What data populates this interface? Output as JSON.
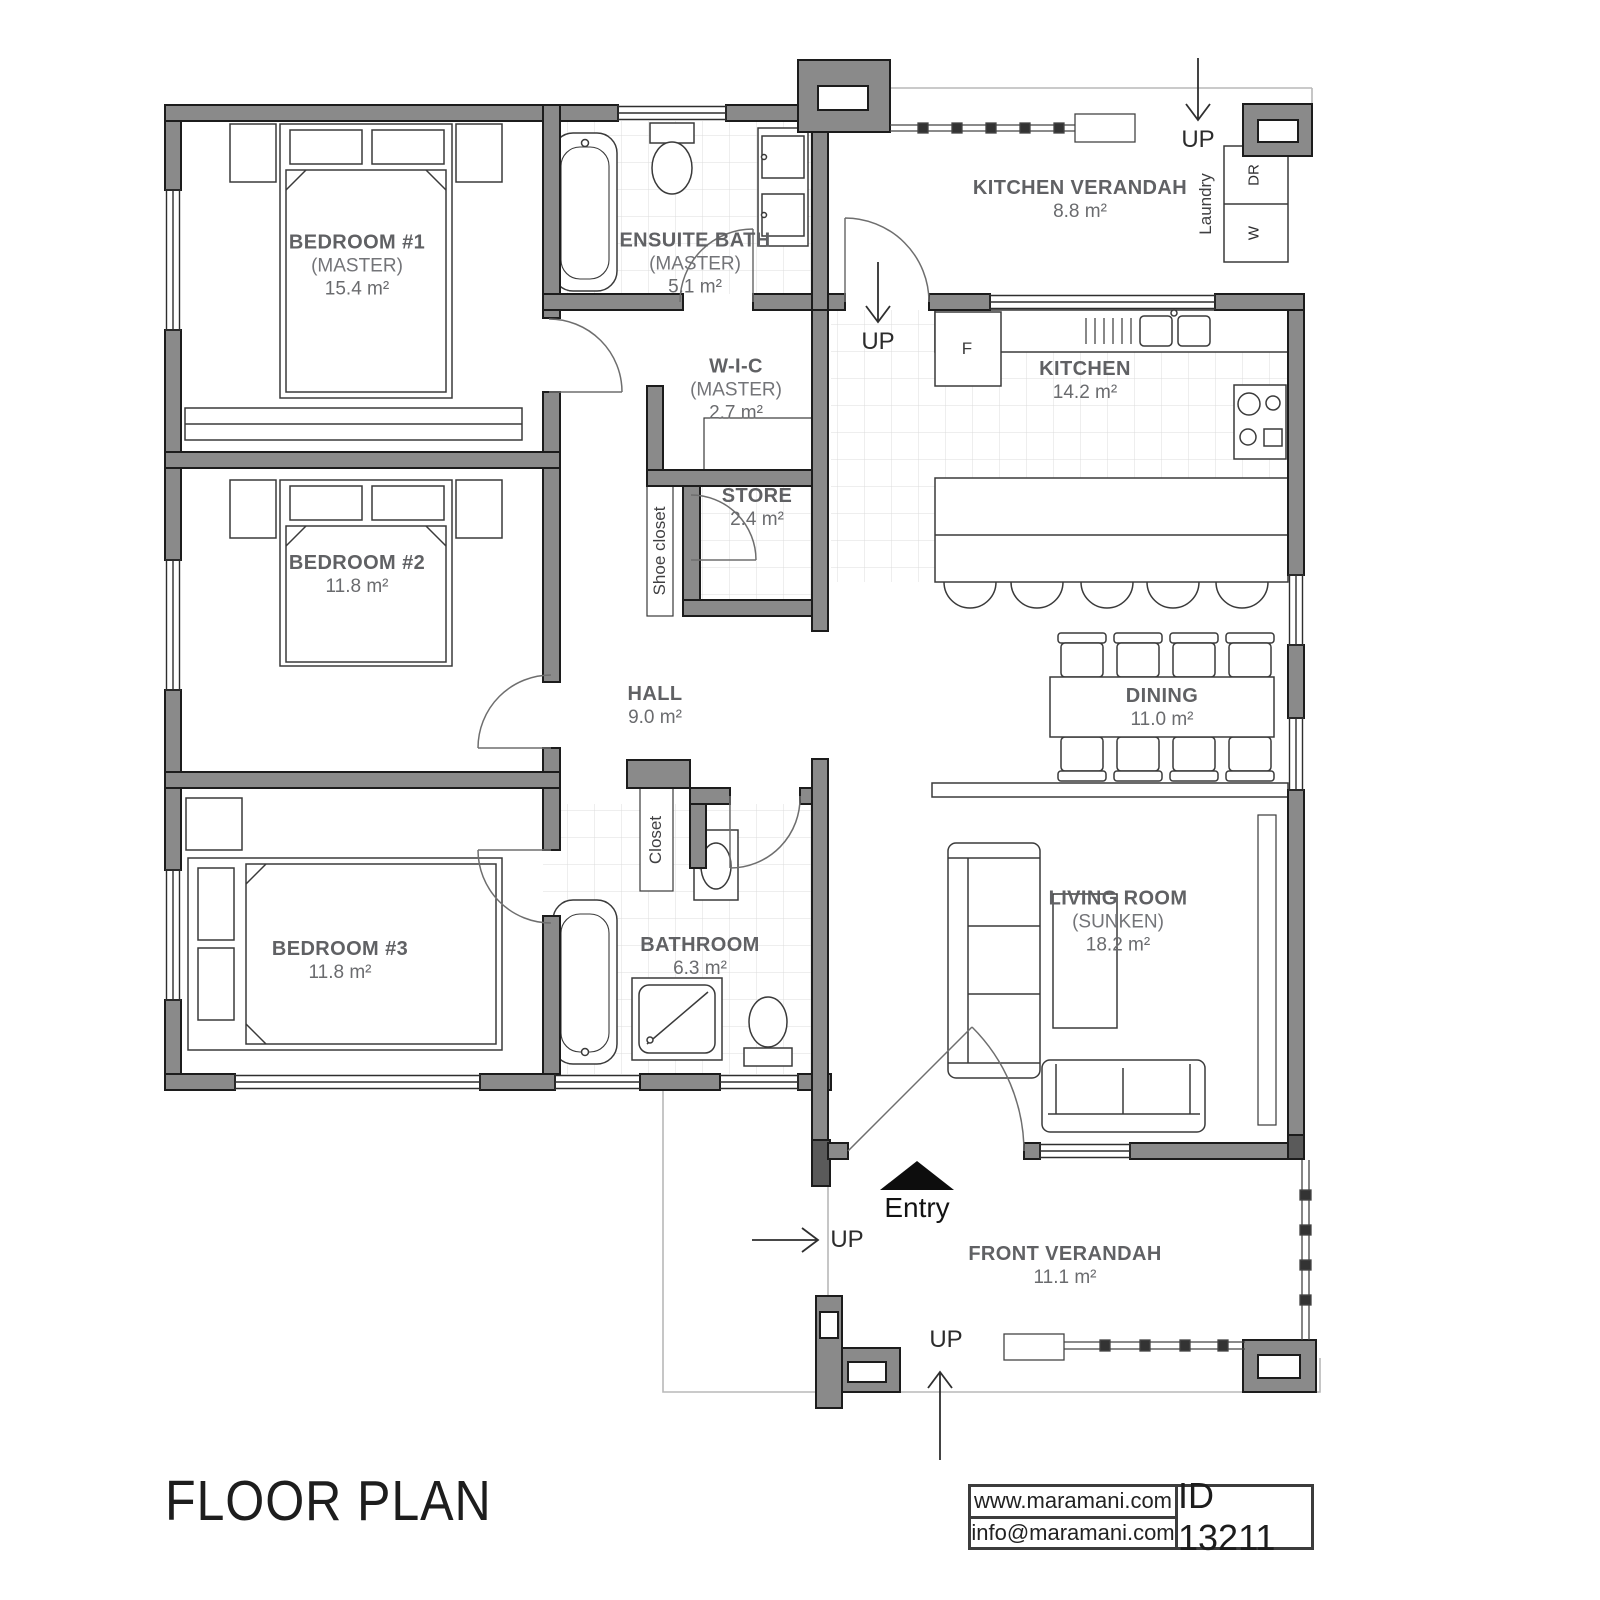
{
  "title": "FLOOR PLAN",
  "branding": {
    "website": "www.maramani.com",
    "email": "info@maramani.com",
    "plan_id": "ID 13211"
  },
  "rooms": {
    "bedroom1": {
      "name": "BEDROOM #1",
      "sub": "(MASTER)",
      "area": "15.4 m²"
    },
    "ensuite": {
      "name": "ENSUITE BATH",
      "sub": "(MASTER)",
      "area": "5.1 m²"
    },
    "kitchen_verandah": {
      "name": "KITCHEN VERANDAH",
      "area": "8.8 m²"
    },
    "wic": {
      "name": "W-I-C",
      "sub": "(MASTER)",
      "area": "2.7 m²"
    },
    "kitchen": {
      "name": "KITCHEN",
      "area": "14.2 m²"
    },
    "store": {
      "name": "STORE",
      "area": "2.4 m²"
    },
    "bedroom2": {
      "name": "BEDROOM #2",
      "area": "11.8 m²"
    },
    "hall": {
      "name": "HALL",
      "area": "9.0 m²"
    },
    "dining": {
      "name": "DINING",
      "area": "11.0 m²"
    },
    "bedroom3": {
      "name": "BEDROOM #3",
      "area": "11.8 m²"
    },
    "bathroom": {
      "name": "BATHROOM",
      "area": "6.3 m²"
    },
    "living": {
      "name": "LIVING ROOM",
      "sub": "(SUNKEN)",
      "area": "18.2 m²"
    },
    "front_verandah": {
      "name": "FRONT VERANDAH",
      "area": "11.1 m²"
    }
  },
  "annotations": {
    "laundry": "Laundry",
    "dryer": "DR",
    "washer": "W",
    "fridge": "F",
    "shoe_closet": "Shoe closet",
    "closet": "Closet",
    "entry": "Entry",
    "up": "UP"
  },
  "colors": {
    "wall": "#8a8a8a",
    "line": "#2e2e2e",
    "label_text": "#636466"
  }
}
